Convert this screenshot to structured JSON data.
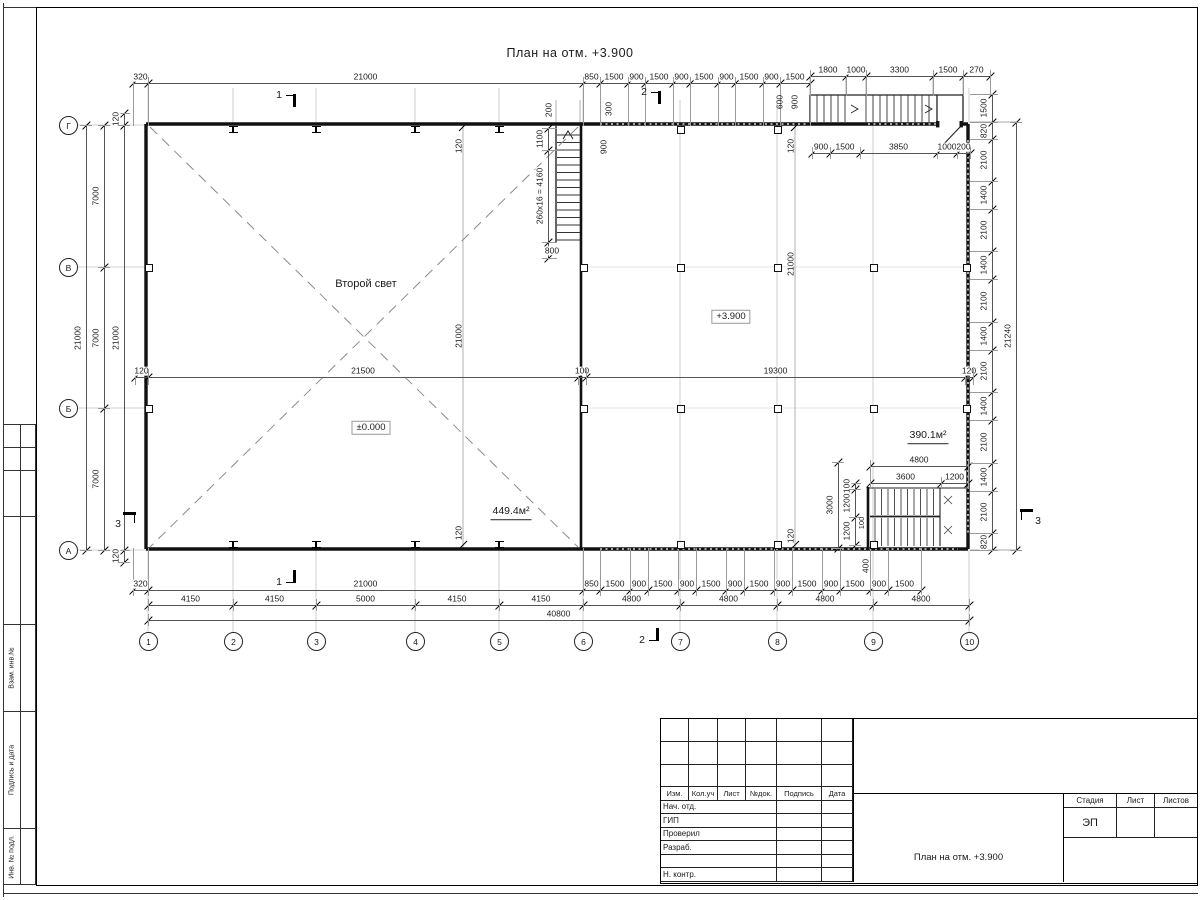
{
  "title": "План на отм. +3.900",
  "free_labels": [
    {
      "t": "Второй свет",
      "x": 366,
      "y": 284,
      "fs": 11
    },
    {
      "t": "+3.900",
      "x": 731,
      "y": 317,
      "box": 1,
      "fs": 9.5
    },
    {
      "t": "±0.000",
      "x": 371,
      "y": 428,
      "box": 1,
      "fs": 9.5
    },
    {
      "t": "449.4м²",
      "x": 511,
      "y": 513,
      "fs": 10.5,
      "und": 1
    },
    {
      "t": "390.1м²",
      "x": 928,
      "y": 437,
      "fs": 10.5,
      "und": 1
    },
    {
      "t": "200",
      "x": 549,
      "y": 110,
      "rot": 1
    },
    {
      "t": "300",
      "x": 609,
      "y": 109,
      "rot": 1
    },
    {
      "t": "600",
      "x": 780,
      "y": 102,
      "rot": 1
    },
    {
      "t": "900",
      "x": 795,
      "y": 102,
      "rot": 1
    },
    {
      "t": "900",
      "x": 604,
      "y": 147,
      "rot": 1
    },
    {
      "t": "120",
      "x": 459,
      "y": 146,
      "rot": 1
    },
    {
      "t": "21000",
      "x": 459,
      "y": 336,
      "rot": 1
    },
    {
      "t": "120",
      "x": 459,
      "y": 533,
      "rot": 1
    },
    {
      "t": "120",
      "x": 791,
      "y": 146,
      "rot": 1
    },
    {
      "t": "21000",
      "x": 791,
      "y": 264,
      "rot": 1
    },
    {
      "t": "120",
      "x": 791,
      "y": 536,
      "rot": 1
    },
    {
      "t": "800",
      "x": 552,
      "y": 251,
      "fs": 8.5
    },
    {
      "t": "400",
      "x": 866,
      "y": 566,
      "rot": 1
    },
    {
      "t": "100",
      "x": 862,
      "y": 523,
      "rot": 1,
      "fs": 7.5
    }
  ],
  "chains": [
    {
      "d": "h",
      "x": 133,
      "y": 83,
      "ext": [
        6,
        43
      ],
      "segs": [
        [
          "320",
          15
        ],
        [
          "21000",
          435
        ],
        [
          "850",
          17
        ],
        [
          "1500",
          28
        ],
        [
          "900",
          17
        ],
        [
          "1500",
          28
        ],
        [
          "900",
          17
        ],
        [
          "1500",
          28
        ],
        [
          "900",
          17
        ],
        [
          "1500",
          28
        ],
        [
          "900",
          17
        ],
        [
          "1500",
          30
        ]
      ]
    },
    {
      "d": "h",
      "x": 810,
      "y": 76,
      "ext": [
        6,
        20
      ],
      "segs": [
        [
          "1800",
          36
        ],
        [
          "1000",
          20
        ],
        [
          "3300",
          67
        ],
        [
          "1500",
          30
        ],
        [
          "270",
          27
        ]
      ]
    },
    {
      "d": "h",
      "x": 812,
      "y": 153,
      "ext": [
        6,
        6
      ],
      "segs": [
        [
          "900",
          18
        ],
        [
          "1500",
          30
        ],
        [
          "3850",
          77
        ],
        [
          "1000",
          20
        ],
        [
          "200",
          13
        ]
      ]
    },
    {
      "d": "h",
      "x": 135,
      "y": 377,
      "ext": [
        8,
        8
      ],
      "segs": [
        [
          "120",
          13
        ],
        [
          "21500",
          430
        ],
        [
          "100",
          8
        ],
        [
          "19300",
          379
        ],
        [
          "120",
          8
        ]
      ]
    },
    {
      "d": "h",
      "x": 133,
      "y": 590,
      "ext": [
        42,
        6
      ],
      "segs": [
        [
          "320",
          15
        ],
        [
          "21000",
          435
        ],
        [
          "850",
          17
        ],
        [
          "1500",
          30
        ],
        [
          "900",
          18
        ],
        [
          "1500",
          30
        ],
        [
          "900",
          18
        ],
        [
          "1500",
          30
        ],
        [
          "900",
          18
        ],
        [
          "1500",
          30
        ],
        [
          "900",
          18
        ],
        [
          "1500",
          30
        ],
        [
          "900",
          18
        ],
        [
          "1500",
          30
        ],
        [
          "900",
          18
        ],
        [
          "1500",
          33
        ]
      ]
    },
    {
      "d": "h",
      "x": 148,
      "y": 605,
      "ext": [
        6,
        6
      ],
      "segs": [
        [
          "4150",
          85
        ],
        [
          "4150",
          83
        ],
        [
          "5000",
          99
        ],
        [
          "4150",
          84
        ],
        [
          "4150",
          84
        ],
        [
          "4800",
          97
        ],
        [
          "4800",
          97
        ],
        [
          "4800",
          96
        ],
        [
          "4800",
          96
        ]
      ]
    },
    {
      "d": "h",
      "x": 148,
      "y": 620,
      "ext": [
        6,
        6
      ],
      "segs": [
        [
          "40800",
          821
        ]
      ]
    },
    {
      "d": "h",
      "x": 870,
      "y": 466,
      "ext": [
        6,
        20
      ],
      "segs": [
        [
          "4800",
          98
        ]
      ]
    },
    {
      "d": "h",
      "x": 870,
      "y": 483,
      "ext": [
        6,
        6
      ],
      "segs": [
        [
          "3600",
          71
        ],
        [
          "1200",
          27
        ]
      ]
    },
    {
      "d": "v",
      "x": 86,
      "y": 125,
      "ext": [
        6,
        6
      ],
      "segs": [
        [
          "21000",
          425
        ]
      ]
    },
    {
      "d": "v",
      "x": 104,
      "y": 125,
      "ext": [
        6,
        6
      ],
      "segs": [
        [
          "7000",
          142
        ],
        [
          "7000",
          141
        ],
        [
          "7000",
          142
        ]
      ]
    },
    {
      "d": "v",
      "x": 124,
      "y": 113,
      "ext": [
        6,
        6
      ],
      "segs": [
        [
          "120",
          12
        ],
        [
          "21000",
          425
        ],
        [
          "120",
          12
        ]
      ]
    },
    {
      "d": "v",
      "x": 992,
      "y": 94,
      "ext": [
        22,
        6
      ],
      "segs": [
        [
          "1500",
          28
        ],
        [
          "820",
          17
        ],
        [
          "2100",
          42
        ],
        [
          "1400",
          28
        ],
        [
          "2100",
          42
        ],
        [
          "1400",
          28
        ],
        [
          "2100",
          43
        ],
        [
          "1400",
          28
        ],
        [
          "2100",
          42
        ],
        [
          "1400",
          28
        ],
        [
          "2100",
          43
        ],
        [
          "1400",
          28
        ],
        [
          "2100",
          42
        ],
        [
          "820",
          17
        ]
      ]
    },
    {
      "d": "v",
      "x": 1016,
      "y": 122,
      "ext": [
        6,
        6
      ],
      "segs": [
        [
          "21240",
          428
        ]
      ]
    },
    {
      "d": "v",
      "x": 548,
      "y": 128,
      "ext": [
        6,
        9
      ],
      "segs": [
        [
          "1100",
          22
        ],
        [
          "260x16 = 4160",
          92
        ],
        [
          "",
          16
        ]
      ]
    },
    {
      "d": "v",
      "x": 855,
      "y": 483,
      "ext": [
        6,
        6
      ],
      "segs": [
        [
          "100",
          6
        ],
        [
          "1200",
          28
        ],
        [
          "1200",
          28
        ]
      ]
    },
    {
      "d": "v",
      "x": 838,
      "y": 462,
      "ext": [
        6,
        6
      ],
      "segs": [
        [
          "3000",
          86
        ]
      ]
    }
  ],
  "axes": {
    "cols": [
      [
        "1",
        148
      ],
      [
        "2",
        233
      ],
      [
        "3",
        316
      ],
      [
        "4",
        415
      ],
      [
        "5",
        499
      ],
      [
        "6",
        583
      ],
      [
        "7",
        680
      ],
      [
        "8",
        777
      ],
      [
        "9",
        873
      ],
      [
        "10",
        969
      ]
    ],
    "cols_y": 641,
    "rows": [
      [
        "Г",
        125
      ],
      [
        "В",
        267
      ],
      [
        "Б",
        408
      ],
      [
        "А",
        550
      ]
    ],
    "rows_x": 68
  },
  "sections": [
    {
      "t": "1",
      "x": 279,
      "y": 95,
      "f": "b"
    },
    {
      "t": "1",
      "x": 279,
      "y": 582,
      "f": "t"
    },
    {
      "t": "2",
      "x": 644,
      "y": 92,
      "f": "b"
    },
    {
      "t": "2",
      "x": 642,
      "y": 640,
      "f": "t"
    },
    {
      "t": "3",
      "x": 118,
      "y": 524,
      "f": "r"
    },
    {
      "t": "3",
      "x": 1038,
      "y": 521,
      "f": "l"
    }
  ],
  "plan_geometry": {
    "squares": [
      [
        583,
        267
      ],
      [
        680,
        267
      ],
      [
        777,
        267
      ],
      [
        873,
        267
      ],
      [
        966,
        267
      ],
      [
        583,
        408
      ],
      [
        680,
        408
      ],
      [
        777,
        408
      ],
      [
        873,
        408
      ],
      [
        966,
        408
      ],
      [
        680,
        129
      ],
      [
        777,
        129
      ],
      [
        148,
        267
      ],
      [
        148,
        408
      ],
      [
        680,
        544
      ],
      [
        777,
        544
      ],
      [
        873,
        544
      ]
    ],
    "tees": [
      [
        233,
        126
      ],
      [
        316,
        126
      ],
      [
        415,
        126
      ],
      [
        499,
        126
      ],
      [
        233,
        541
      ],
      [
        316,
        541
      ],
      [
        415,
        541
      ],
      [
        499,
        541
      ]
    ]
  },
  "titleblock": {
    "header": [
      "Изм.",
      "Кол.уч",
      "Лист",
      "№док.",
      "Подпись",
      "Дата"
    ],
    "rows": [
      "Нач. отд.",
      "ГИП",
      "Проверил",
      "Разраб.",
      "",
      "Н. контр."
    ],
    "doc_title": "План на отм. +3.900",
    "stage_cols": [
      "Стадия",
      "Лист",
      "Листов"
    ],
    "stage_value": "ЭП"
  },
  "margin": {
    "rows": [
      {
        "h": 23,
        "t": ""
      },
      {
        "h": 23,
        "t": ""
      },
      {
        "h": 46,
        "t": ""
      },
      {
        "h": 109,
        "t": ""
      },
      {
        "h": 87,
        "t": "Взам. инв.№"
      },
      {
        "h": 118,
        "t": "Подпись и дата"
      },
      {
        "h": 55,
        "t": "Инв. № подл."
      }
    ]
  }
}
